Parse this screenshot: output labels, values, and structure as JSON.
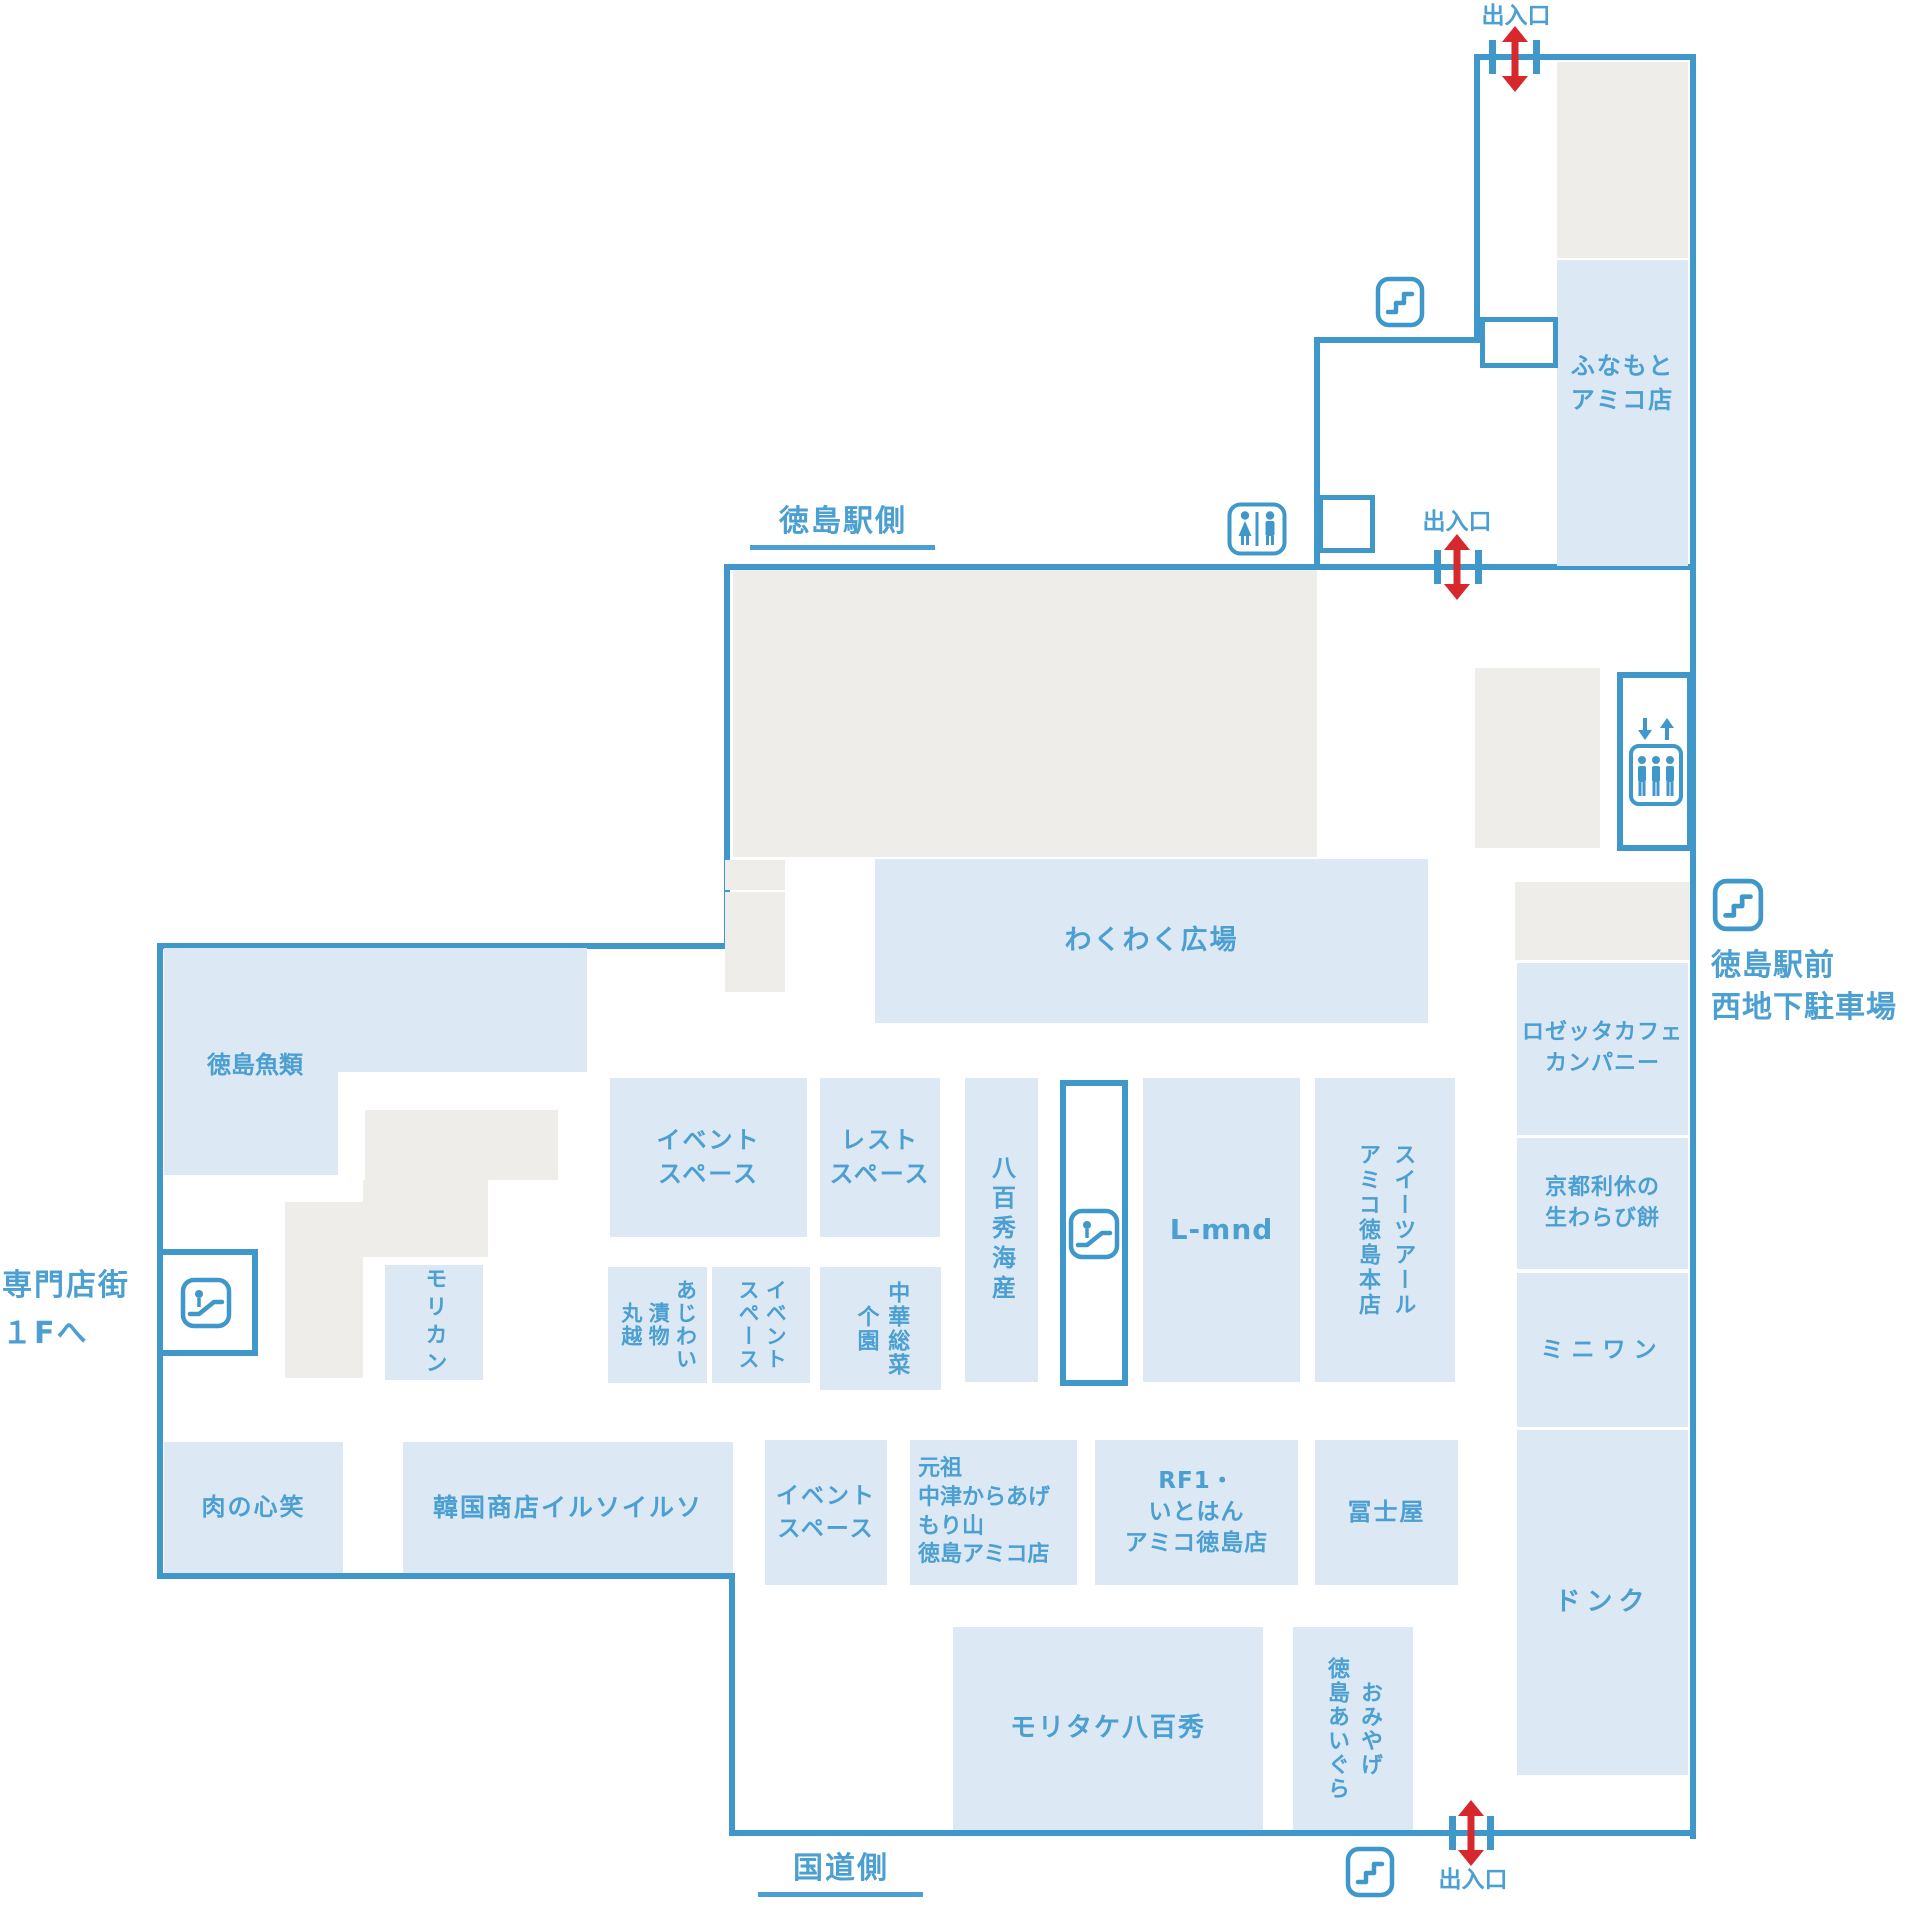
{
  "exits": {
    "top": "出入口",
    "middle": "出入口",
    "bottom": "出入口"
  },
  "directions": {
    "station_side": "徳島駅側",
    "road_side": "国道側",
    "parking": "徳島駅前\n西地下駐車場",
    "specialty_floor": "専門店街\n１Fへ"
  },
  "rooms": {
    "funamoto": "ふなもと\nアミコ店",
    "wakuwaku": "わくわく広場",
    "gyorui": "徳島魚類",
    "morikan": "モリカン",
    "event1": "イベント\nスペース",
    "rest": "レスト\nスペース",
    "ajiwai": "あじわい\n漬物\n丸越",
    "event2": "イベント\nスペース",
    "chuka": "中華総菜\n个園",
    "yaohide": "八百秀海産",
    "lmnd": "L-mnd",
    "sweets": "スイーツアール\nアミコ徳島本店",
    "rosetta": "ロゼッタカフェ\nカンパニー",
    "kyoto": "京都利休の\n生わらび餅",
    "miniwan": "ミニワン",
    "donq": "ドンク",
    "niku": "肉の心笑",
    "kankoku": "韓国商店イルソイルソ",
    "event3": "イベント\nスペース",
    "ganso": "元祖\n中津からあげ\nもり山\n徳島アミコ店",
    "rf1": "RF1・\nいとはん\nアミコ徳島店",
    "fujiya": "冨士屋",
    "moritake": "モリタケ八百秀",
    "omiyage": "おみやげ\n徳島あいぐら"
  },
  "icons": {
    "stairs": "stairs-icon",
    "toilet": "restroom-icon",
    "elevator": "elevator-icon",
    "escalator": "escalator-icon",
    "entrance": "red-double-arrow"
  },
  "colors": {
    "wall": "#3f98c9",
    "room_fill": "#dce9f4",
    "gray_fill": "#efedea",
    "label_text": "#4b9fd1",
    "arrow_red": "#d7282d"
  }
}
